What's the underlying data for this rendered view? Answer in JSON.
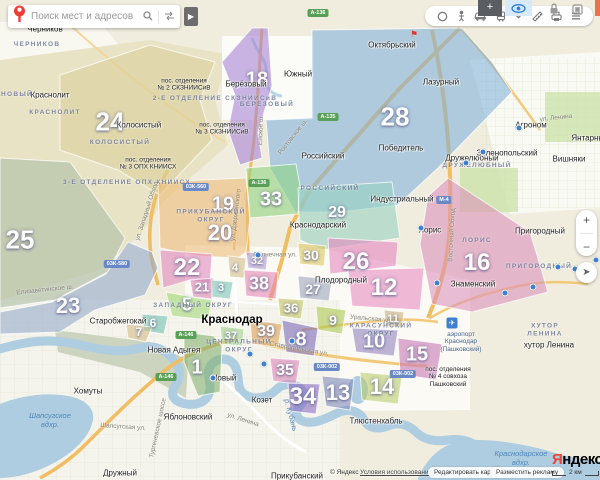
{
  "search": {
    "placeholder": "Поиск мест и адресов"
  },
  "zoom": {
    "plus": "+",
    "minus": "−"
  },
  "toolbar": {
    "icons": [
      "layers-icon",
      "panorama-icon",
      "traffic-icon",
      "transport-icon",
      "collapse-chevron-icon",
      "ruler-icon",
      "print-icon",
      "menu-icon"
    ]
  },
  "browser": {
    "extensions": [
      "plus-tile",
      "eye-tile",
      "lock-icon",
      "window-icon"
    ]
  },
  "footer": {
    "copyright": "© Яндекс",
    "terms": "Условия использования",
    "edit": "Редактировать карту",
    "ads": "Разместить рекламу",
    "scale": "2 км",
    "logo_ya": "Я",
    "logo_rest": "ндекс"
  },
  "map": {
    "city": {
      "name": "Краснодар",
      "x": 232,
      "y": 320
    },
    "region_numbers": [
      {
        "num": "24",
        "x": 110,
        "y": 122,
        "size": 26
      },
      {
        "num": "25",
        "x": 20,
        "y": 240,
        "size": 26
      },
      {
        "num": "28",
        "x": 395,
        "y": 117,
        "size": 26
      },
      {
        "num": "23",
        "x": 68,
        "y": 306,
        "size": 22
      },
      {
        "num": "18",
        "x": 257,
        "y": 80,
        "size": 20
      },
      {
        "num": "19",
        "x": 223,
        "y": 205,
        "size": 20
      },
      {
        "num": "20",
        "x": 220,
        "y": 233,
        "size": 22
      },
      {
        "num": "33",
        "x": 271,
        "y": 200,
        "size": 20
      },
      {
        "num": "29",
        "x": 337,
        "y": 213,
        "size": 16
      },
      {
        "num": "22",
        "x": 187,
        "y": 268,
        "size": 24
      },
      {
        "num": "21",
        "x": 202,
        "y": 287,
        "size": 13
      },
      {
        "num": "5",
        "x": 187,
        "y": 305,
        "size": 18
      },
      {
        "num": "6",
        "x": 153,
        "y": 323,
        "size": 12
      },
      {
        "num": "7",
        "x": 139,
        "y": 332,
        "size": 12
      },
      {
        "num": "1",
        "x": 197,
        "y": 368,
        "size": 20
      },
      {
        "num": "3",
        "x": 221,
        "y": 288,
        "size": 11
      },
      {
        "num": "4",
        "x": 235,
        "y": 268,
        "size": 11
      },
      {
        "num": "32",
        "x": 257,
        "y": 261,
        "size": 11
      },
      {
        "num": "38",
        "x": 259,
        "y": 284,
        "size": 18
      },
      {
        "num": "36",
        "x": 291,
        "y": 308,
        "size": 13
      },
      {
        "num": "37",
        "x": 231,
        "y": 336,
        "size": 11
      },
      {
        "num": "39",
        "x": 266,
        "y": 332,
        "size": 16
      },
      {
        "num": "27",
        "x": 313,
        "y": 289,
        "size": 14
      },
      {
        "num": "30",
        "x": 311,
        "y": 255,
        "size": 14
      },
      {
        "num": "26",
        "x": 356,
        "y": 262,
        "size": 24
      },
      {
        "num": "12",
        "x": 384,
        "y": 288,
        "size": 24
      },
      {
        "num": "16",
        "x": 477,
        "y": 263,
        "size": 24
      },
      {
        "num": "9",
        "x": 333,
        "y": 320,
        "size": 14
      },
      {
        "num": "8",
        "x": 301,
        "y": 340,
        "size": 20
      },
      {
        "num": "35",
        "x": 285,
        "y": 371,
        "size": 16
      },
      {
        "num": "10",
        "x": 374,
        "y": 342,
        "size": 20
      },
      {
        "num": "11",
        "x": 393,
        "y": 319,
        "size": 11
      },
      {
        "num": "15",
        "x": 417,
        "y": 355,
        "size": 20
      },
      {
        "num": "13",
        "x": 338,
        "y": 393,
        "size": 22
      },
      {
        "num": "14",
        "x": 382,
        "y": 387,
        "size": 22
      },
      {
        "num": "34",
        "x": 303,
        "y": 397,
        "size": 24
      }
    ],
    "towns": [
      {
        "name": "Черников",
        "x": 45,
        "y": 29
      },
      {
        "name": "Краснолит",
        "x": 50,
        "y": 95
      },
      {
        "name": "Колосистый",
        "x": 139,
        "y": 125
      },
      {
        "name": "Берёзовый",
        "x": 246,
        "y": 84
      },
      {
        "name": "Южный",
        "x": 298,
        "y": 74
      },
      {
        "name": "Октябрьский",
        "x": 392,
        "y": 45
      },
      {
        "name": "Лазурный",
        "x": 441,
        "y": 82
      },
      {
        "name": "Победитель",
        "x": 401,
        "y": 148
      },
      {
        "name": "Российский",
        "x": 323,
        "y": 156
      },
      {
        "name": "Краснодарский",
        "x": 318,
        "y": 225
      },
      {
        "name": "Индустриальный",
        "x": 402,
        "y": 199
      },
      {
        "name": "Дружелюбный",
        "x": 472,
        "y": 158
      },
      {
        "name": "Зеленопольский",
        "x": 507,
        "y": 153
      },
      {
        "name": "Агроном",
        "x": 531,
        "y": 125
      },
      {
        "name": "Вишняки",
        "x": 569,
        "y": 159
      },
      {
        "name": "Янтарный",
        "x": 590,
        "y": 138
      },
      {
        "name": "Пригородный",
        "x": 540,
        "y": 231
      },
      {
        "name": "Лорис",
        "x": 430,
        "y": 230
      },
      {
        "name": "Знаменский",
        "x": 473,
        "y": 284
      },
      {
        "name": "Плодородный",
        "x": 341,
        "y": 280
      },
      {
        "name": "хутор Ленина",
        "x": 549,
        "y": 345
      },
      {
        "name": "Старобжегокай",
        "x": 118,
        "y": 321
      },
      {
        "name": "Новая Адыгея",
        "x": 174,
        "y": 350
      },
      {
        "name": "Новый",
        "x": 224,
        "y": 378
      },
      {
        "name": "Козет",
        "x": 262,
        "y": 400
      },
      {
        "name": "Яблоновский",
        "x": 188,
        "y": 417
      },
      {
        "name": "Хомуты",
        "x": 88,
        "y": 391
      },
      {
        "name": "Дружный",
        "x": 120,
        "y": 473
      },
      {
        "name": "Тлюстенхабль",
        "x": 376,
        "y": 421
      },
      {
        "name": "Прикубанский",
        "x": 297,
        "y": 476
      }
    ],
    "districts": [
      {
        "name": "ЧЕРНИКОВ",
        "x": 37,
        "y": 45
      },
      {
        "name": "НОВЫЙ",
        "x": 17,
        "y": 95
      },
      {
        "name": "КРАСНОЛИТ",
        "x": 55,
        "y": 113
      },
      {
        "name": "КОЛОСИСТЫЙ",
        "x": 120,
        "y": 143
      },
      {
        "name": "2-Е ОТДЕЛЕНИЕ СКЗНИИСиВ",
        "x": 215,
        "y": 99
      },
      {
        "name": "3-Е ОТДЕЛЕНИЕ ОПХ КНИИСХ",
        "x": 127,
        "y": 183
      },
      {
        "name": "БЕРЁЗОВЫЙ",
        "x": 267,
        "y": 105
      },
      {
        "name": "ПРИКУБАНСКИЙ\nОКРУГ",
        "x": 211,
        "y": 217
      },
      {
        "name": "ЦЕНТРАЛЬНЫЙ\nОКРУГ",
        "x": 239,
        "y": 347
      },
      {
        "name": "КАРАСУНСКИЙ\nОКРУГ",
        "x": 381,
        "y": 331
      },
      {
        "name": "ЗАПАДНЫЙ ОКРУГ",
        "x": 193,
        "y": 306
      },
      {
        "name": "РОССИЙСКИЙ",
        "x": 330,
        "y": 189
      },
      {
        "name": "ДРУЖЕЛЮБНЫЙ",
        "x": 477,
        "y": 166
      },
      {
        "name": "ЛОРИС",
        "x": 477,
        "y": 241
      },
      {
        "name": "ПРИГОРОДНЫЙ",
        "x": 539,
        "y": 267
      },
      {
        "name": "ХУТОР ЛЕНИНА",
        "x": 545,
        "y": 331
      }
    ],
    "settlements": [
      {
        "name": "пос. отделения\n№ 2 СКЗНИИСиВ",
        "x": 184,
        "y": 85
      },
      {
        "name": "пос. отделения\n№ 3 СКЗНИИСиВ",
        "x": 222,
        "y": 129
      },
      {
        "name": "пос. отделения\n№ 3 ОПХ КНИИСХ",
        "x": 148,
        "y": 164
      },
      {
        "name": "пос. отделения\n№ 4 совхоза\nПашковский",
        "x": 448,
        "y": 377
      }
    ],
    "airport": {
      "name": "аэропорт\nКраснодар\n(Пашковский)",
      "x": 461,
      "y": 331,
      "icon_x": 452,
      "icon_y": 323
    },
    "roads": [
      {
        "name": "ул. Дзержинского",
        "x": 236,
        "y": 215,
        "rot": -83
      },
      {
        "name": "Ростовское ш.",
        "x": 293,
        "y": 137,
        "rot": -52
      },
      {
        "name": "Ейское ш.",
        "x": 261,
        "y": 130,
        "rot": -88
      },
      {
        "name": "ул. Западный Обход",
        "x": 147,
        "y": 211,
        "rot": -72
      },
      {
        "name": "Восточный Обход",
        "x": 452,
        "y": 235,
        "rot": -87
      },
      {
        "name": "Елизаветинское ш.",
        "x": 45,
        "y": 290,
        "rot": -6
      },
      {
        "name": "ул. Ленина",
        "x": 243,
        "y": 420,
        "rot": 18
      },
      {
        "name": "ул. Ленина",
        "x": 556,
        "y": 118,
        "rot": -6
      },
      {
        "name": "Солнечная ул.",
        "x": 275,
        "y": 255,
        "rot": 0
      },
      {
        "name": "Уральская ул.",
        "x": 371,
        "y": 319,
        "rot": 5
      },
      {
        "name": "Ставропольская ул.",
        "x": 299,
        "y": 349,
        "rot": 10
      },
      {
        "name": "Шапсугская ул.",
        "x": 123,
        "y": 427,
        "rot": 4
      },
      {
        "name": "Тургеневское шоссе",
        "x": 158,
        "y": 428,
        "rot": -78
      }
    ],
    "waters": [
      {
        "name": "Шапсугское\nвдхр.",
        "x": 50,
        "y": 420,
        "rot": 0
      },
      {
        "name": "Краснодарское\nвдхр.",
        "x": 521,
        "y": 458,
        "rot": 0
      },
      {
        "name": "р. Кубань",
        "x": 291,
        "y": 415,
        "rot": 75
      }
    ],
    "shields": [
      {
        "text": "А-136",
        "x": 318,
        "y": 13,
        "type": "federal"
      },
      {
        "text": "А-136",
        "x": 259,
        "y": 183,
        "type": "federal"
      },
      {
        "text": "03К-560",
        "x": 196,
        "y": 187,
        "type": "regional"
      },
      {
        "text": "А-135",
        "x": 328,
        "y": 117,
        "type": "federal"
      },
      {
        "text": "03К-580",
        "x": 117,
        "y": 264,
        "type": "regional"
      },
      {
        "text": "М-4",
        "x": 444,
        "y": 200,
        "type": "regional"
      },
      {
        "text": "А-146",
        "x": 186,
        "y": 335,
        "type": "federal"
      },
      {
        "text": "А-146",
        "x": 166,
        "y": 377,
        "type": "federal"
      },
      {
        "text": "03К-002",
        "x": 327,
        "y": 367,
        "type": "regional"
      },
      {
        "text": "03К-002",
        "x": 403,
        "y": 374,
        "type": "regional"
      }
    ],
    "pois": [
      {
        "x": 213,
        "y": 378
      },
      {
        "x": 258,
        "y": 255
      },
      {
        "x": 483,
        "y": 152
      },
      {
        "x": 466,
        "y": 163
      },
      {
        "x": 519,
        "y": 128
      },
      {
        "x": 421,
        "y": 228
      },
      {
        "x": 250,
        "y": 354
      },
      {
        "x": 264,
        "y": 364
      },
      {
        "x": 558,
        "y": 267
      },
      {
        "x": 575,
        "y": 269
      },
      {
        "x": 596,
        "y": 260
      },
      {
        "x": 533,
        "y": 287
      },
      {
        "x": 505,
        "y": 293
      },
      {
        "x": 437,
        "y": 283
      },
      {
        "x": 292,
        "y": 341
      }
    ],
    "flag_marker": {
      "x": 414,
      "y": 40
    }
  }
}
